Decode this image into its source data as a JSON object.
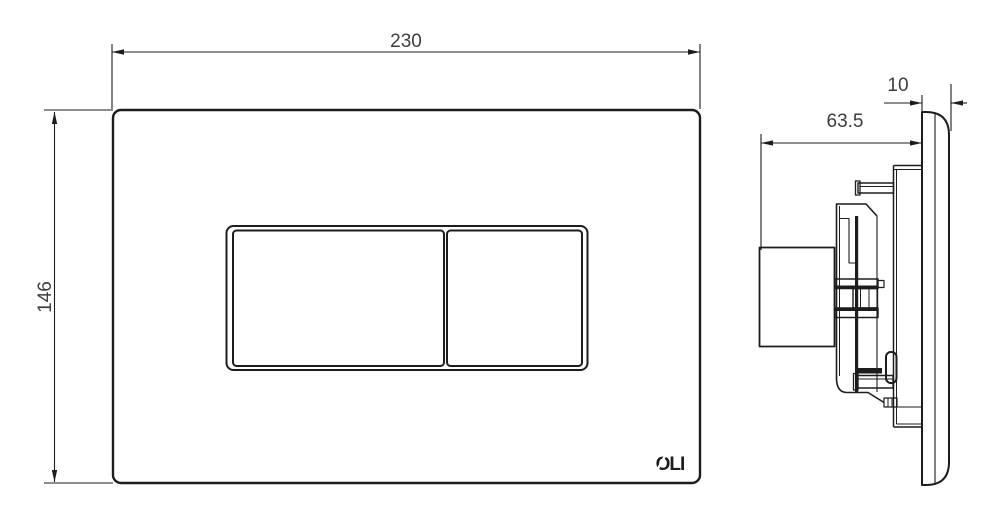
{
  "colors": {
    "line": "#1d1d1b",
    "dim_text": "#3d3d3d",
    "background": "#ffffff"
  },
  "front_view": {
    "width_label": "230",
    "height_label": "146",
    "logo_text": "OLI"
  },
  "side_view": {
    "depth_label": "63.5",
    "thickness_label": "10"
  }
}
